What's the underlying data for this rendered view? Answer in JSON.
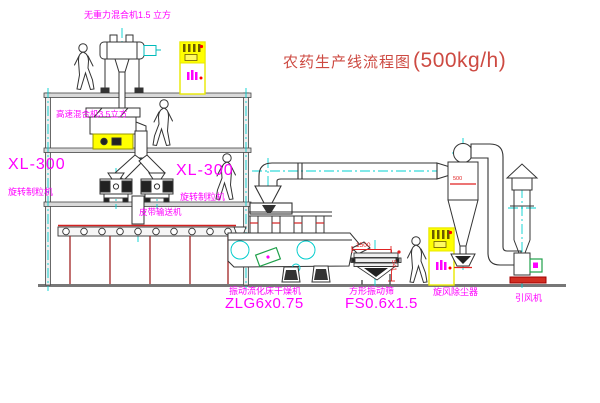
{
  "title": {
    "name": "农药生产线流程图",
    "capacity": "(500kg/h)"
  },
  "colors": {
    "line": "#333333",
    "centerline": "#00d0d0",
    "label_magenta": "#ff00ff",
    "title_red": "#cd4a42",
    "dimension_red": "#e02222",
    "cabinet_yellow": "#ffff00",
    "motor_green": "#1fa04a",
    "ground_gray": "#777777"
  },
  "labels": {
    "gravity_mixer": "无重力混合机1.5 立方",
    "high_speed_mixer": "高速混合机3.5立方",
    "granulator_model_left": "XL-300",
    "granulator_name_left": "旋转制粒机",
    "granulator_model_right": "XL-300",
    "granulator_name_right": "旋转制粒机",
    "belt_conveyor": "皮带输送机",
    "dryer_name": "振动流化床干燥机",
    "dryer_model": "ZLG6x0.75",
    "screen_name": "方形振动筛",
    "screen_model": "FS0.6x1.5",
    "cyclone": "旋风除尘器",
    "fan": "引风机"
  },
  "dimensions": {
    "screen_length": "1500",
    "screen_height": "541",
    "cyclone_marking": "500"
  }
}
